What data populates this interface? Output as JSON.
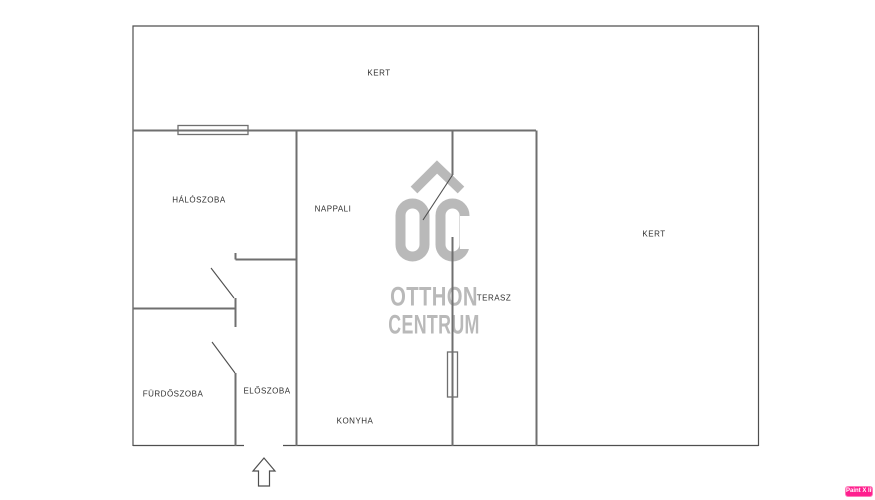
{
  "plan": {
    "rooms": [
      {
        "label": "KERT"
      },
      {
        "label": "KERT"
      },
      {
        "label": "HÁLÓSZOBA"
      },
      {
        "label": "NAPPALI"
      },
      {
        "label": "TERASZ"
      },
      {
        "label": "FÜRDŐSZOBA"
      },
      {
        "label": "ELŐSZOBA"
      },
      {
        "label": "KONYHA"
      }
    ]
  },
  "logo": {
    "monogram": "OC",
    "word1": "OTTHON",
    "word2": "CENTRUM"
  },
  "badge": {
    "label": "Paint X lite"
  },
  "colors": {
    "background": "#ffffff",
    "wall": "#6f6f6f",
    "boundary": "#4f4f4f",
    "label_text": "#2f2f2f",
    "logo_gray": "#b9b9b9",
    "badge_pink": "#ff1f8f"
  }
}
